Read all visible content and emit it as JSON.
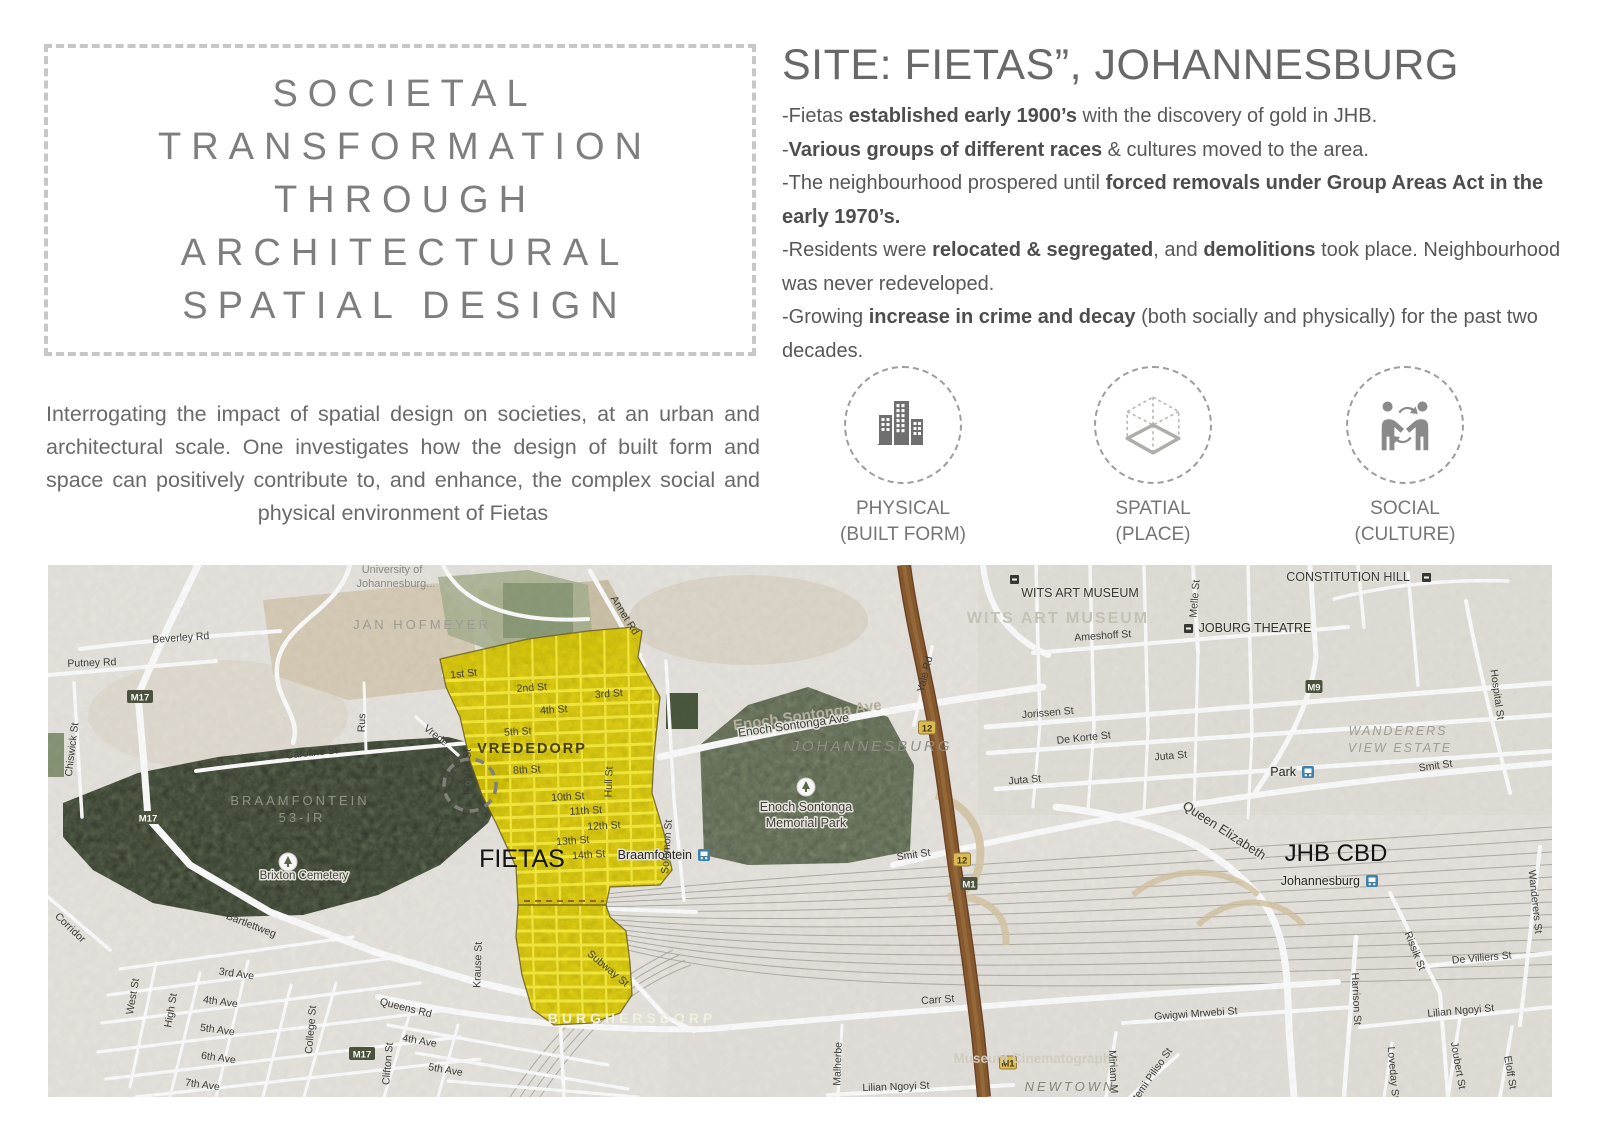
{
  "title_box": {
    "lines": [
      "SOCIETAL",
      "TRANSFORMATION",
      "THROUGH",
      "ARCHITECTURAL",
      "SPATIAL DESIGN"
    ]
  },
  "intro": {
    "text": "Interrogating the impact of spatial design on societies, at an urban and architectural scale. One investigates how the design of built form and space can positively contribute to, and enhance, the complex social and physical environment of Fietas"
  },
  "site": {
    "heading": "SITE: FIETAS”, JOHANNESBURG",
    "bullets": [
      {
        "segments": [
          {
            "t": "-Fietas ",
            "b": false
          },
          {
            "t": "established early 1900’s",
            "b": true
          },
          {
            "t": " with the discovery of gold in JHB.",
            "b": false
          }
        ]
      },
      {
        "segments": [
          {
            "t": "-",
            "b": false
          },
          {
            "t": "Various groups of different races",
            "b": true
          },
          {
            "t": " & cultures moved to the area.",
            "b": false
          }
        ]
      },
      {
        "segments": [
          {
            "t": "-The neighbourhood prospered until ",
            "b": false
          },
          {
            "t": "forced removals under Group Areas Act in the early 1970’s.",
            "b": true
          }
        ]
      },
      {
        "segments": [
          {
            "t": "-Residents were ",
            "b": false
          },
          {
            "t": "relocated & segregated",
            "b": true
          },
          {
            "t": ", and ",
            "b": false
          },
          {
            "t": "demolitions",
            "b": true
          },
          {
            "t": " took place. Neigh­bourhood was never redeveloped.",
            "b": false
          }
        ]
      },
      {
        "segments": [
          {
            "t": "-Growing ",
            "b": false
          },
          {
            "t": "increase in crime and decay",
            "b": true
          },
          {
            "t": " (both socially and physically) for the",
            "b": false
          },
          {
            "t": " past two decades.",
            "b": false
          }
        ]
      }
    ]
  },
  "concepts": [
    {
      "icon": "buildings-icon",
      "line1": "PHYSICAL",
      "line2": "(BUILT FORM)"
    },
    {
      "icon": "isometric-cube-icon",
      "line1": "SPATIAL",
      "line2": "(PLACE)"
    },
    {
      "icon": "people-exchange-icon",
      "line1": "SOCIAL",
      "line2": "(CULTURE)"
    }
  ],
  "map": {
    "colors": {
      "highlight_yellow": "#f2df04",
      "forest_green": "#6e7c60",
      "park_green": "#8a9779",
      "highway_brown": "#8a5c30",
      "badge_green": "#4d5640",
      "badge_yellow": "#e5c257",
      "station_blue": "#4286b4",
      "base": "#eae7e1"
    },
    "labels": [
      {
        "t": "University of",
        "x": 344,
        "y": 8,
        "s": 11,
        "c": "#8e8d85"
      },
      {
        "t": "Johannesburg...",
        "x": 348,
        "y": 22,
        "s": 11,
        "c": "#8e8d85"
      },
      {
        "t": "JAN HOFMEYER",
        "x": 374,
        "y": 64,
        "s": 13,
        "c": "#a2a198",
        "ls": 3
      },
      {
        "t": "BRAAMFONTEIN",
        "x": 252,
        "y": 240,
        "s": 13,
        "c": "#95988a",
        "ls": 3
      },
      {
        "t": "53-IR",
        "x": 254,
        "y": 257,
        "s": 13,
        "c": "#95988a",
        "ls": 3
      },
      {
        "t": "VREDEDORP",
        "x": 484,
        "y": 188,
        "s": 14.5,
        "c": "#463f14",
        "ls": 2,
        "b": 1
      },
      {
        "t": "FIETAS",
        "x": 474,
        "y": 302,
        "s": 25,
        "c": "#141414"
      },
      {
        "t": "JHB CBD",
        "x": 1288,
        "y": 296,
        "s": 24,
        "c": "#141414"
      },
      {
        "t": "BURGHERSDORP",
        "x": 584,
        "y": 458,
        "s": 14,
        "c": "#fbf8ea",
        "ls": 4,
        "b": 1
      },
      {
        "t": "JOHANNESBURG",
        "x": 824,
        "y": 186,
        "s": 15,
        "c": "#96958d",
        "ls": 3,
        "i": 1
      },
      {
        "t": "WANDERERS",
        "x": 1350,
        "y": 170,
        "s": 12.5,
        "c": "#a7a39a",
        "ls": 2,
        "i": 1
      },
      {
        "t": "VIEW ESTATE",
        "x": 1352,
        "y": 187,
        "s": 12.5,
        "c": "#a7a39a",
        "ls": 2,
        "i": 1
      },
      {
        "t": "NEWTOWN",
        "x": 1022,
        "y": 526,
        "s": 13,
        "c": "#8b897f",
        "ls": 3,
        "i": 1
      },
      {
        "t": "Museum Cinematography",
        "x": 988,
        "y": 498,
        "s": 13.5,
        "c": "#d7d3c5",
        "b": 1
      },
      {
        "t": "CONSTITUTION HILL",
        "x": 1300,
        "y": 16,
        "s": 12.5,
        "c": "#3d3d3a",
        "h": 2
      },
      {
        "t": "WITS ART MUSEUM",
        "x": 1010,
        "y": 58,
        "s": 16,
        "c": "#cbc8bb",
        "ls": 2,
        "b": 1
      },
      {
        "t": "WITS ART MUSEUM",
        "x": 1032,
        "y": 32,
        "s": 12.5,
        "c": "#393936",
        "h": 2
      },
      {
        "t": "Enoch Sontonga",
        "x": 758,
        "y": 246,
        "s": 12.5,
        "c": "#44443c",
        "h": 3
      },
      {
        "t": "Memorial Park",
        "x": 758,
        "y": 262,
        "s": 12.5,
        "c": "#44443c",
        "h": 3
      },
      {
        "t": "Brixton Cemetery",
        "x": 256,
        "y": 314,
        "s": 11.5,
        "c": "#47473f",
        "h": 3
      },
      {
        "t": "JOBURG THEATRE",
        "x": 1207,
        "y": 67,
        "s": 12.5,
        "c": "#34342f",
        "h": 2
      },
      {
        "t": "Beverley Rd",
        "x": 133,
        "y": 76,
        "r": -4
      },
      {
        "t": "Putney Rd",
        "x": 44,
        "y": 101,
        "r": -2
      },
      {
        "t": "Chiswick St",
        "x": 27,
        "y": 185,
        "r": -83
      },
      {
        "t": "Caroline St",
        "x": 264,
        "y": 191,
        "r": -6
      },
      {
        "t": "Rus",
        "x": 317,
        "y": 158,
        "r": -88
      },
      {
        "t": "Vrede",
        "x": 386,
        "y": 173,
        "r": 38
      },
      {
        "t": "Annet Rd",
        "x": 574,
        "y": 52,
        "r": 58
      },
      {
        "t": "1st St",
        "x": 416,
        "y": 112,
        "r": -6
      },
      {
        "t": "2nd St",
        "x": 484,
        "y": 126,
        "r": -4
      },
      {
        "t": "3rd St",
        "x": 561,
        "y": 132,
        "r": -4
      },
      {
        "t": "4th St",
        "x": 506,
        "y": 148,
        "r": -4
      },
      {
        "t": "5th St",
        "x": 470,
        "y": 170,
        "r": -3
      },
      {
        "t": "8th St",
        "x": 479,
        "y": 208,
        "r": -3
      },
      {
        "t": "10th St",
        "x": 520,
        "y": 235,
        "r": -3
      },
      {
        "t": "11th St",
        "x": 538,
        "y": 249,
        "r": -3
      },
      {
        "t": "12th St",
        "x": 556,
        "y": 264,
        "r": -3
      },
      {
        "t": "13th St",
        "x": 525,
        "y": 279,
        "r": -4
      },
      {
        "t": "14th St",
        "x": 541,
        "y": 293,
        "r": -4
      },
      {
        "t": "Krause St",
        "x": 422,
        "y": 207,
        "r": -88
      },
      {
        "t": "Krause St",
        "x": 433,
        "y": 400,
        "r": -88
      },
      {
        "t": "Hull St",
        "x": 564,
        "y": 217,
        "r": -88
      },
      {
        "t": "Solomon St",
        "x": 622,
        "y": 282,
        "r": -86
      },
      {
        "t": "Subway St",
        "x": 558,
        "y": 406,
        "r": 40
      },
      {
        "t": "Bartlettweg",
        "x": 202,
        "y": 363,
        "r": 21
      },
      {
        "t": "Corridor",
        "x": 20,
        "y": 365,
        "r": 44
      },
      {
        "t": "Queens Rd",
        "x": 357,
        "y": 446,
        "r": 14
      },
      {
        "t": "West St",
        "x": 88,
        "y": 432,
        "r": -80
      },
      {
        "t": "High St",
        "x": 126,
        "y": 446,
        "r": -80
      },
      {
        "t": "3rd Ave",
        "x": 188,
        "y": 412,
        "r": 8
      },
      {
        "t": "4th Ave",
        "x": 172,
        "y": 440,
        "r": 8
      },
      {
        "t": "5th Ave",
        "x": 169,
        "y": 468,
        "r": 8
      },
      {
        "t": "6th Ave",
        "x": 170,
        "y": 496,
        "r": 8
      },
      {
        "t": "7th Ave",
        "x": 154,
        "y": 523,
        "r": 8
      },
      {
        "t": "College St",
        "x": 266,
        "y": 465,
        "r": -85
      },
      {
        "t": "Clifton St",
        "x": 343,
        "y": 499,
        "r": -85
      },
      {
        "t": "4th Ave",
        "x": 371,
        "y": 479,
        "r": 10
      },
      {
        "t": "5th Ave",
        "x": 397,
        "y": 508,
        "r": 10
      },
      {
        "t": "Enoch Sontonga Ave",
        "x": 760,
        "y": 155,
        "s": 15,
        "c": "#bcb6a4",
        "r": -8,
        "b": 1
      },
      {
        "t": "Enoch Sontonga Ave",
        "x": 746,
        "y": 164,
        "s": 12,
        "r": -8,
        "h": 3
      },
      {
        "t": "Yale Rd",
        "x": 880,
        "y": 110,
        "r": -76
      },
      {
        "t": "Smit St",
        "x": 866,
        "y": 293,
        "r": -8
      },
      {
        "t": "Smit St",
        "x": 1388,
        "y": 204,
        "r": -8
      },
      {
        "t": "Juta St",
        "x": 977,
        "y": 218,
        "r": -5
      },
      {
        "t": "Juta St",
        "x": 1123,
        "y": 194,
        "r": -5
      },
      {
        "t": "Jorissen St",
        "x": 1000,
        "y": 151,
        "r": -5
      },
      {
        "t": "De Korte St",
        "x": 1036,
        "y": 176,
        "r": -6
      },
      {
        "t": "Ameshoff St",
        "x": 1055,
        "y": 74,
        "r": -4
      },
      {
        "t": "Melle St",
        "x": 1150,
        "y": 34,
        "r": -85
      },
      {
        "t": "Hospital St",
        "x": 1446,
        "y": 130,
        "r": 82
      },
      {
        "t": "Queen Elizabeth",
        "x": 1174,
        "y": 269,
        "s": 13,
        "r": 33,
        "h": 3
      },
      {
        "t": "Carr St",
        "x": 890,
        "y": 438,
        "r": -4
      },
      {
        "t": "Gwigwi Mrwebi St",
        "x": 1148,
        "y": 452,
        "r": -4
      },
      {
        "t": "Lilian Ngoyi St",
        "x": 1413,
        "y": 449,
        "r": -5
      },
      {
        "t": "Lilian Ngoyi St",
        "x": 848,
        "y": 525,
        "r": -2
      },
      {
        "t": "De Villiers St",
        "x": 1434,
        "y": 396,
        "r": -5
      },
      {
        "t": "Rissik St",
        "x": 1364,
        "y": 387,
        "r": 68
      },
      {
        "t": "Harrison St",
        "x": 1305,
        "y": 434,
        "r": 87
      },
      {
        "t": "Wanderers St",
        "x": 1484,
        "y": 337,
        "r": 84
      },
      {
        "t": "Joubert St",
        "x": 1407,
        "y": 501,
        "r": 80
      },
      {
        "t": "Eloff St",
        "x": 1459,
        "y": 508,
        "r": 80
      },
      {
        "t": "Loveday St",
        "x": 1342,
        "y": 508,
        "r": 85
      },
      {
        "t": "Miriam M",
        "x": 1062,
        "y": 507,
        "r": 87
      },
      {
        "t": "Ntemi Piliso St",
        "x": 1105,
        "y": 514,
        "r": -55
      },
      {
        "t": "Malherbe",
        "x": 793,
        "y": 499,
        "r": -88
      }
    ],
    "badges": [
      {
        "t": "M17",
        "x": 92,
        "y": 132,
        "k": "g"
      },
      {
        "t": "M17",
        "x": 100,
        "y": 253,
        "k": "g"
      },
      {
        "t": "M17",
        "x": 314,
        "y": 489,
        "k": "g"
      },
      {
        "t": "M9",
        "x": 1266,
        "y": 122,
        "k": "g"
      },
      {
        "t": "M1",
        "x": 921,
        "y": 319,
        "k": "g"
      },
      {
        "t": "M1",
        "x": 960,
        "y": 498,
        "k": "r"
      },
      {
        "t": "12",
        "x": 879,
        "y": 163,
        "k": "r"
      },
      {
        "t": "12",
        "x": 914,
        "y": 295,
        "k": "r"
      }
    ],
    "stations": [
      {
        "label": "Braamfontein",
        "x": 650,
        "y": 284
      },
      {
        "label": "Park",
        "x": 1254,
        "y": 201
      },
      {
        "label": "Johannesburg",
        "x": 1318,
        "y": 310
      }
    ],
    "poi": [
      {
        "k": "sq",
        "x": 1136,
        "y": 59,
        "name": "theatre-icon"
      },
      {
        "k": "sq",
        "x": 1374,
        "y": 8,
        "name": "constitution-hill-icon"
      },
      {
        "k": "sq",
        "x": 962,
        "y": 10,
        "name": "museum-icon"
      },
      {
        "k": "tree",
        "x": 758,
        "y": 222,
        "name": "park-tree-icon"
      },
      {
        "k": "tree",
        "x": 240,
        "y": 297,
        "name": "cemetery-icon"
      }
    ]
  }
}
